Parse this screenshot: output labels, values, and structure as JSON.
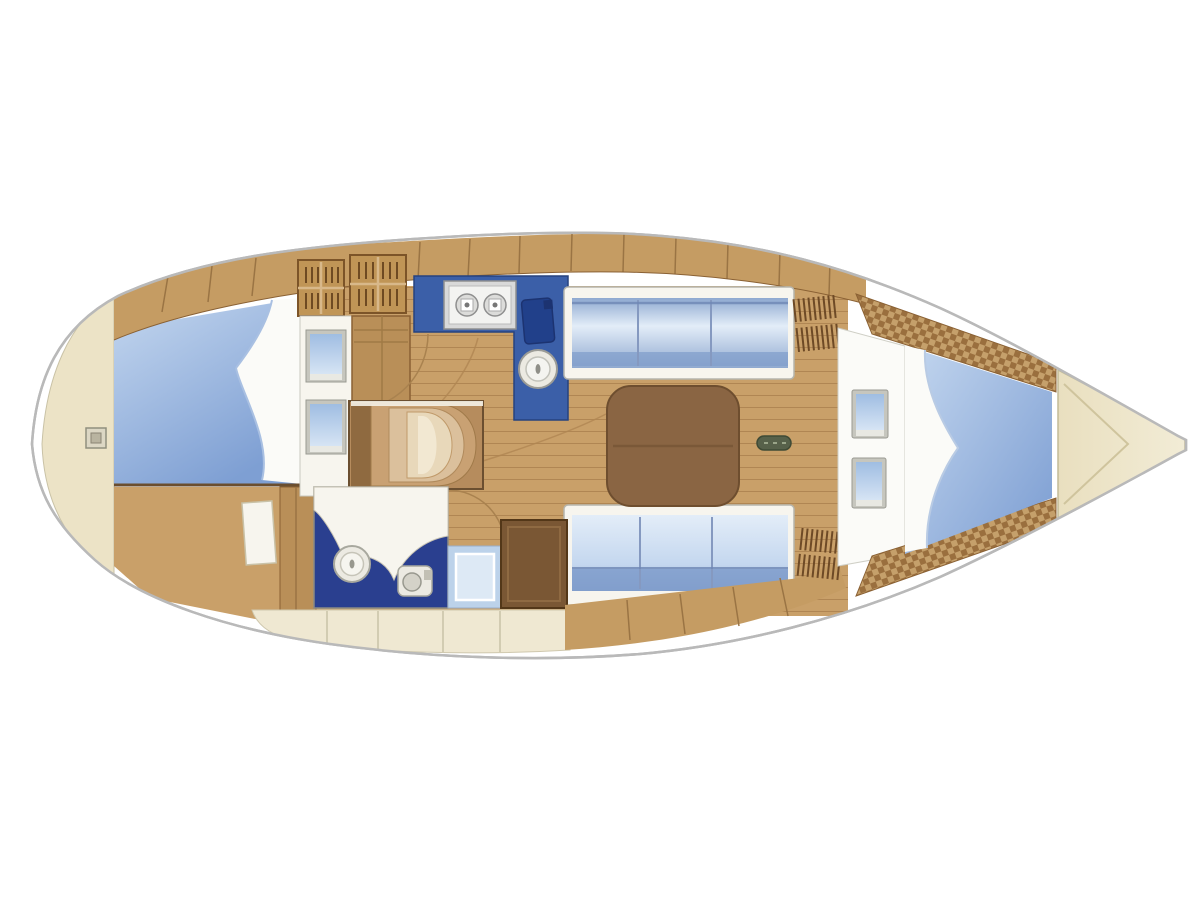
{
  "diagram": {
    "type": "boat-floor-plan",
    "subject": "sailing-yacht-interior-layout",
    "orientation": "bow-right-stern-left",
    "visible_text": ""
  },
  "colors": {
    "background": "#ffffff",
    "hull_outline": "#b9b9b9",
    "deck_white": "#ffffff",
    "wood": "#c59c63",
    "wood_line": "#9a7444",
    "wood_edge": "#8a6134",
    "floor": "#c9a069",
    "floor_line": "#b08653",
    "wardrobe": "#b98f58",
    "cream_locker": "#efe8d2",
    "cream_line": "#cfc8ae",
    "stern_cream": "#ece3c6",
    "bow_cream": "#e9dfbf",
    "bow_line": "#cfc49d",
    "berth_light": "#c4d7ef",
    "berth_dark": "#7e9fd3",
    "cushion_light": "#e3edf8",
    "cushion_dark": "#8fa9d0",
    "cushion_band": "#7f9ccb",
    "counter_blue": "#3b5fa8",
    "basin_blue": "#21408a",
    "head_floor_navy": "#2a3f8f",
    "white_soft": "#f7f5ee",
    "table_brown": "#8a6543",
    "table_edge": "#6e4e2f",
    "panel_brown": "#7a5734",
    "panel_edge": "#533718",
    "shower_mid": "#bcd2ea",
    "shower_light": "#dde9f5",
    "checker_a": "#c5a06b",
    "checker_b": "#9a6f3e",
    "mast_green": "#57614a",
    "fixture_gray": "#d9d9d9",
    "fixture_white": "#f3f3f1",
    "fixture_ring": "#8f8f8f",
    "porcelain": "#eceae2",
    "porcelain_ring": "#a8a89e",
    "grille_wood": "#c09556",
    "grille_line": "#6e4a22",
    "steps_base": "#b68c5d",
    "steps_arc1": "#c9a173",
    "steps_arc2": "#dbc09c",
    "steps_arc3": "#e8d8ba",
    "steps_arc4": "#f2e8d2",
    "steps_shadow": "#8f6a40",
    "window_frame": "#c6c6be",
    "window_glass_a": "#9fbde2",
    "window_glass_b": "#d6e4f4",
    "fitting_face": "#dcd7c4",
    "fitting_core": "#b9b4a0",
    "blanket_white": "#fbfbf8",
    "bed_separator": "#6b4e2e"
  },
  "regions": [
    {
      "id": "hull",
      "role": "hull-outline"
    },
    {
      "id": "stern-locker",
      "role": "aft-deck-lazarette"
    },
    {
      "id": "aft-berth",
      "role": "aft-cabin-double-berth"
    },
    {
      "id": "aft-cabin-floor",
      "role": "aft-cabin-floor"
    },
    {
      "id": "companionway-steps",
      "role": "entry-steps"
    },
    {
      "id": "galley-counter",
      "role": "galley-l-counter"
    },
    {
      "id": "galley-stove",
      "role": "two-burner-stove"
    },
    {
      "id": "galley-sink",
      "role": "round-sink"
    },
    {
      "id": "head-compartment",
      "role": "bathroom"
    },
    {
      "id": "toilet",
      "role": "toilet"
    },
    {
      "id": "shower-pan",
      "role": "shower-seat"
    },
    {
      "id": "storage-cabinet",
      "role": "dark-cabinet"
    },
    {
      "id": "salon-table",
      "role": "saloon-table"
    },
    {
      "id": "port-settee",
      "role": "upper-settee"
    },
    {
      "id": "starboard-settee",
      "role": "lower-settee"
    },
    {
      "id": "mast-step",
      "role": "mast-foot"
    },
    {
      "id": "v-berth",
      "role": "forward-v-berth"
    },
    {
      "id": "anchor-locker",
      "role": "bow-anchor-locker"
    },
    {
      "id": "shelf-trim-top",
      "role": "forward-hull-shelf"
    },
    {
      "id": "shelf-trim-bottom",
      "role": "forward-hull-shelf"
    },
    {
      "id": "top-lockers",
      "role": "hull-side-lockers"
    },
    {
      "id": "bottom-lockers",
      "role": "hull-side-lockers"
    }
  ]
}
